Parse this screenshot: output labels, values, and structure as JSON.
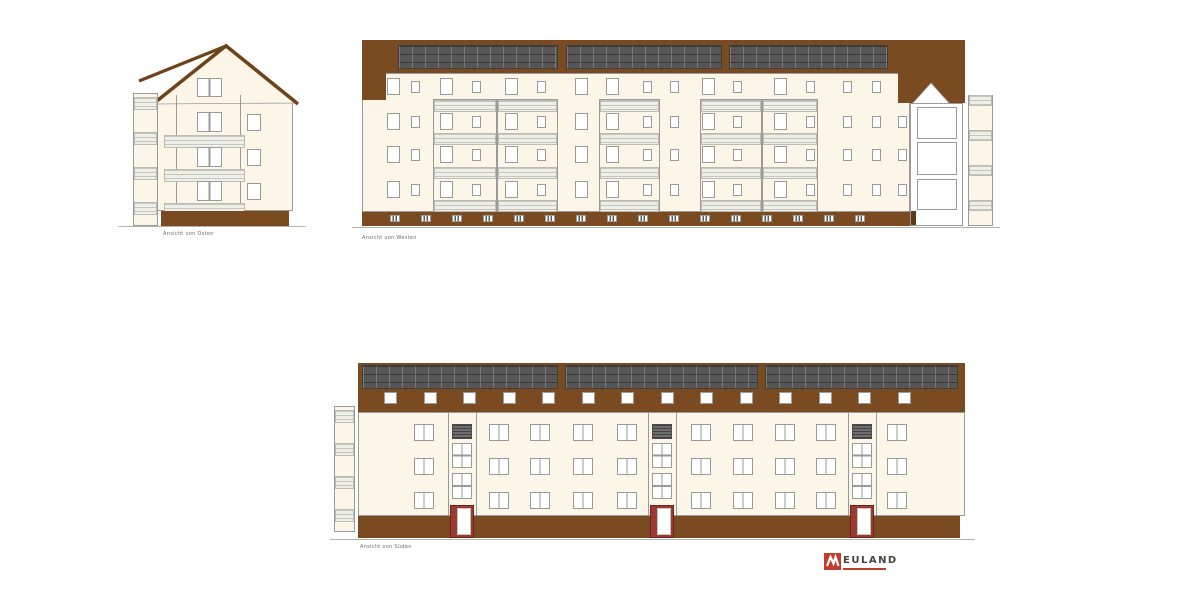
{
  "palette": {
    "background": "#ffffff",
    "facade": "#fbf6e8",
    "brown": "#7a4a21",
    "roof_line": "#6f4318",
    "panel_dark": "#575757",
    "outline": "#9a9a9a",
    "railing": "#efefe9",
    "door_red": "#9c3a31",
    "logo_red": "#c23b2c",
    "logo_text": "#45443e",
    "ground": "#b2b2ac"
  },
  "drawing": {
    "type": "architectural-elevations",
    "floors_main": 4,
    "floors_south": 3
  },
  "elevations": {
    "east": {
      "label": "Ansicht von Osten"
    },
    "west": {
      "label": "Ansicht von Westen"
    },
    "south": {
      "label": "Ansicht von Süden"
    }
  },
  "logo": {
    "name": "NEULAND",
    "wordmark": "EULAND"
  }
}
